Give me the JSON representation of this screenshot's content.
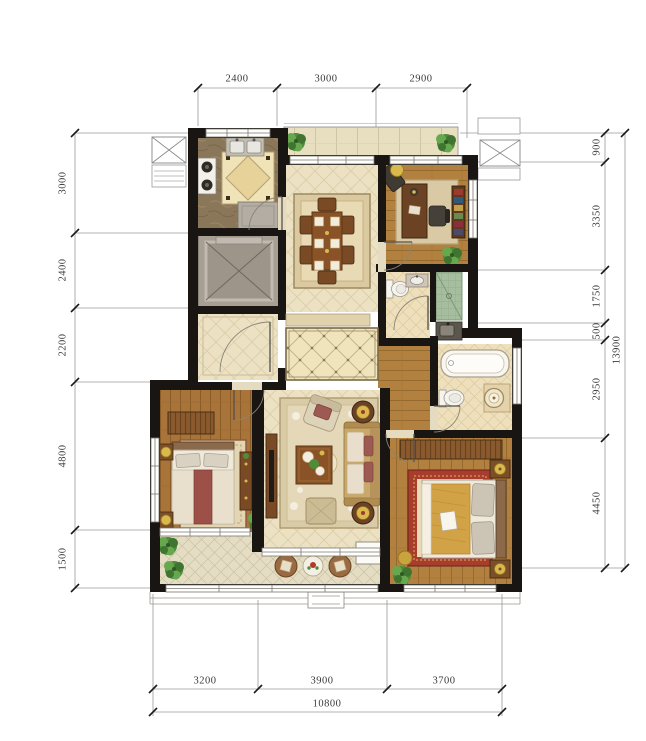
{
  "dimensions": {
    "top": [
      "2400",
      "3000",
      "2900"
    ],
    "left": [
      "3000",
      "2400",
      "2200",
      "4800",
      "1500"
    ],
    "right": [
      "900",
      "3350",
      "1750",
      "500",
      "2950",
      "4450"
    ],
    "right_total": "13900",
    "bottom": [
      "3200",
      "3900",
      "3700"
    ],
    "bottom_total": "10800"
  },
  "colors": {
    "wall": "#181512",
    "dim_line": "#9a9a9a",
    "dim_text": "#3a3a3a",
    "tile": "#ece1c2",
    "wood": "#b3813f",
    "wood_dark": "#a8743a",
    "rug_red": "#a83c2e",
    "shower_green": "#a6bd9e",
    "plant": "#4e8c3a",
    "gold": "#d2a246",
    "elevator_grey": "#a79f93"
  }
}
